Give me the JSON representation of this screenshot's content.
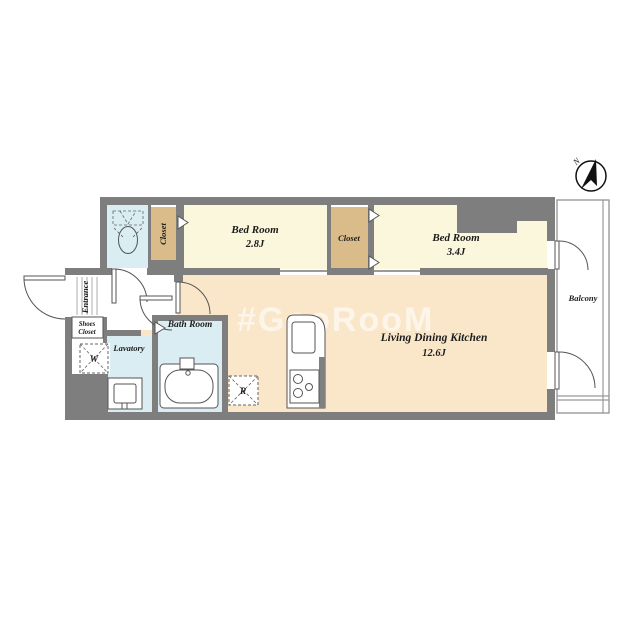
{
  "colors": {
    "wall": "#7e7e7e",
    "bedroom_fill": "#faf7dd",
    "ldk_fill": "#fae7ca",
    "closet_fill": "#d9bc8a",
    "wet_fill": "#d9edf2",
    "balcony_stroke": "#999999"
  },
  "compass": {
    "north_label": "N"
  },
  "watermark": {
    "text": "#GooRooM"
  },
  "rooms": {
    "bedroom1": {
      "name": "Bed Room",
      "size": "2.8J"
    },
    "bedroom2": {
      "name": "Bed Room",
      "size": "3.4J"
    },
    "ldk": {
      "name": "Living Dining Kitchen",
      "size": "12.6J"
    },
    "closet1": {
      "label": "Closet"
    },
    "closet2": {
      "label": "Closet"
    },
    "bath": {
      "label": "Bath Room"
    },
    "lavatory": {
      "label": "Lavatory"
    },
    "entrance": {
      "label": "Entrance"
    },
    "shoes_closet": {
      "line1": "Shoes",
      "line2": "Closet"
    },
    "balcony": {
      "label": "Balcony"
    },
    "washer_space": {
      "label": "W"
    },
    "refrigerator_space": {
      "label": "R"
    }
  }
}
